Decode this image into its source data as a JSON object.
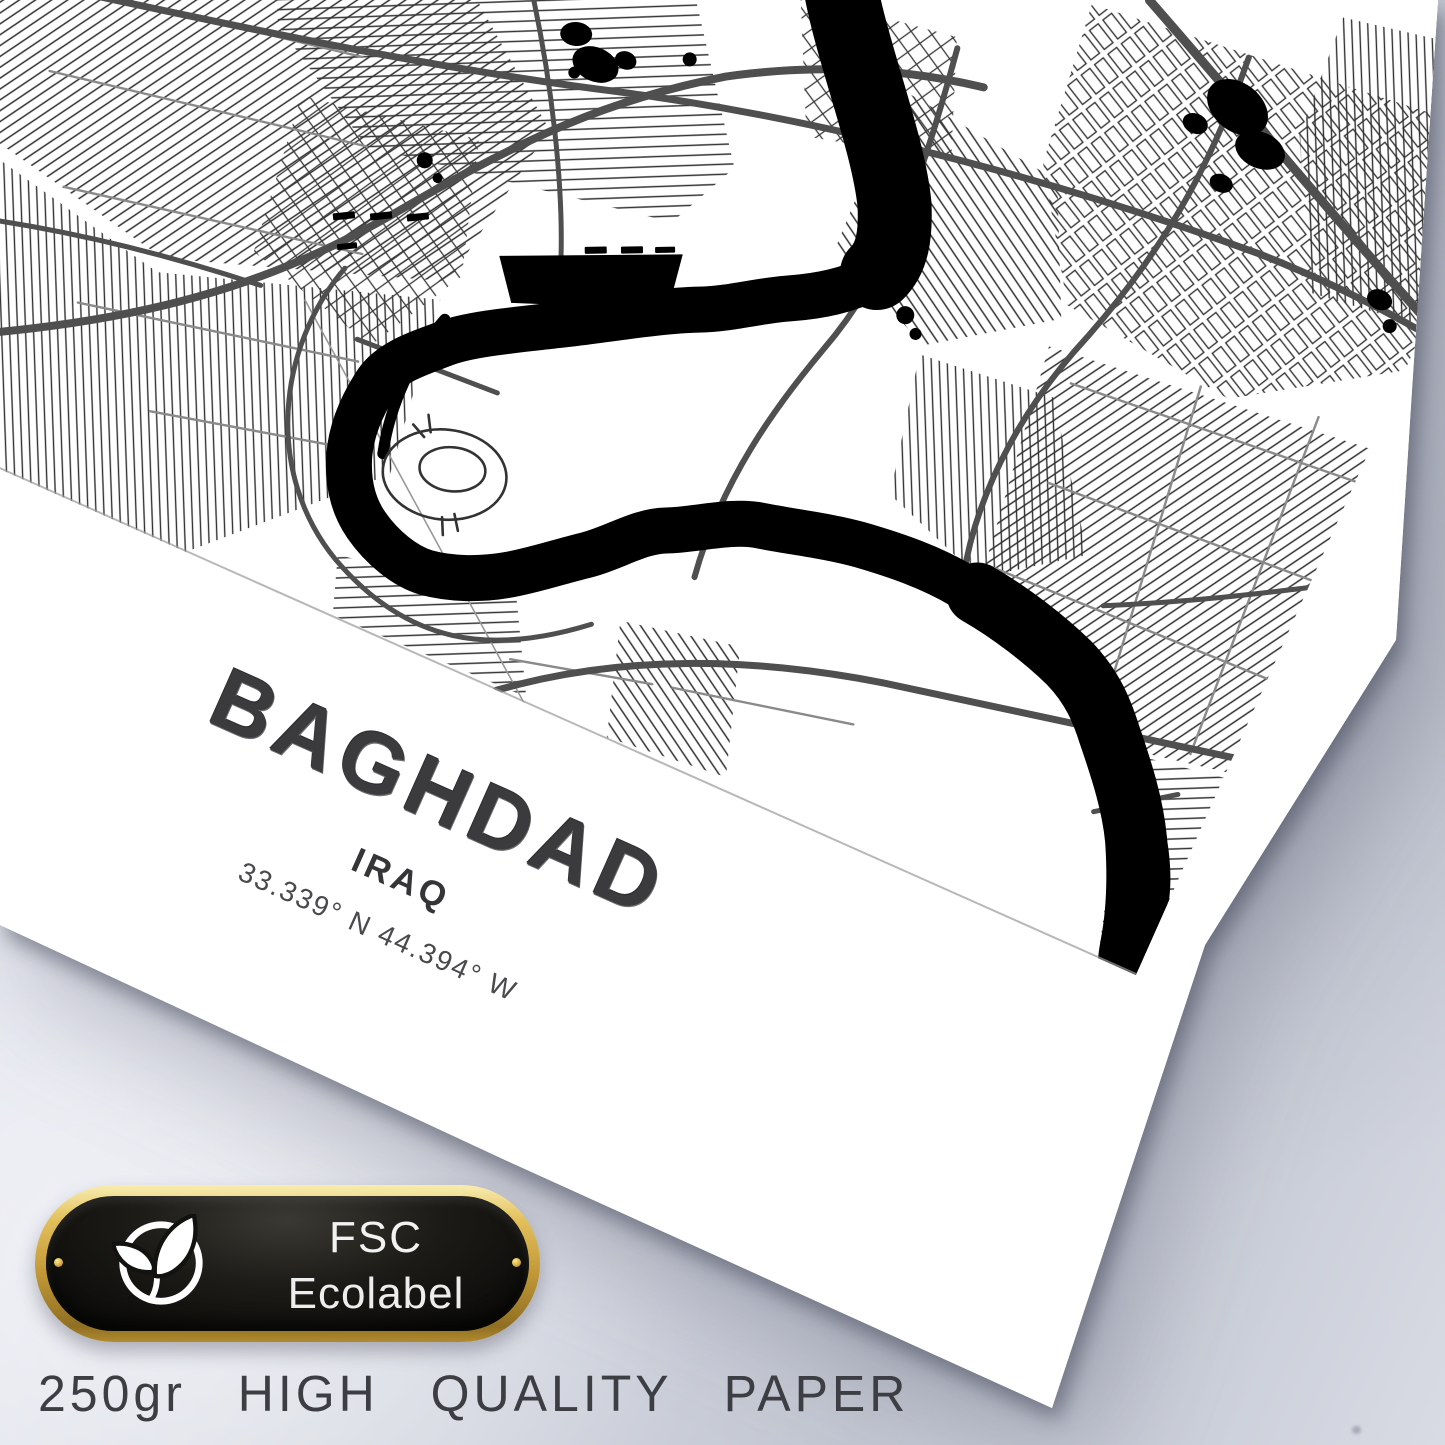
{
  "poster": {
    "city": "BAGHDAD",
    "country": "IRAQ",
    "coordinates": "33.339° N 44.394° W",
    "style": "black-and-white street map print",
    "map_colors": {
      "background": "#ffffff",
      "river": "#000000",
      "major_road": "#4f4f4f",
      "street": "#1e1e1e"
    }
  },
  "badge": {
    "line1": "FSC",
    "line2": "Ecolabel",
    "icon": "eco-leaf-icon",
    "gold": "#c49a38",
    "plate": "#14130f",
    "text_color": "#f2f2f2"
  },
  "caption": {
    "text": "250gr HIGH QUALITY PAPER"
  },
  "backdrop": {
    "light": "#eef0f7",
    "dark": "#c3c7d2",
    "text_dark": "#3b3b3d"
  }
}
